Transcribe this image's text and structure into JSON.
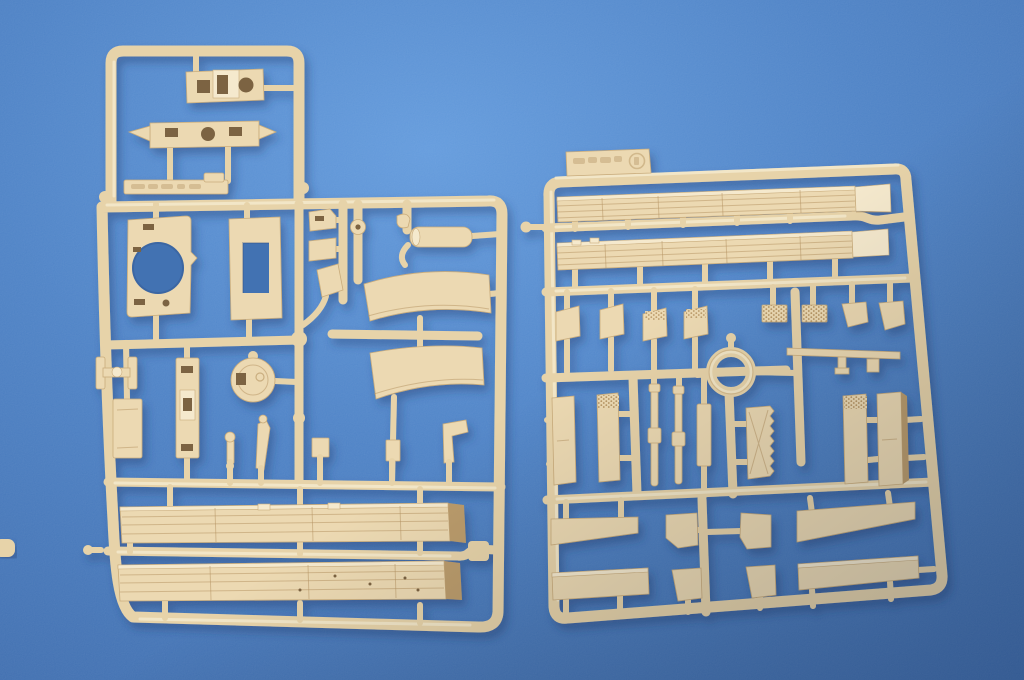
{
  "scene": {
    "type": "photograph",
    "subject": "Two tan injection-molded plastic model kit sprues (part runners) photographed on a blue textured paper backdrop",
    "left_sprue": {
      "shape": "L-shaped frame with narrow upper extension and large lower body",
      "parts": [
        "cab plate with square hatch, raised hatch frame and round opening",
        "front panel bar with pointed ends and three openings",
        "embossed label strip",
        "turret ring plate with large circular opening",
        "frame plate with rectangular opening",
        "two small step brackets",
        "angled wedge piece",
        "eyelet ring",
        "hook fitting",
        "cylindrical muffler with curved pipe",
        "two curved fender panels",
        "axle beam with end flanges",
        "small rectangular panel",
        "tall slotted pillar",
        "round hub disc with slot",
        "five small fittings and levers",
        "two long slatted cargo-bed planks"
      ]
    },
    "right_sprue": {
      "shape": "large rectangular frame with embossed tab at top",
      "parts": [
        "two long slatted side panels with folded ends",
        "two plain mud flaps with posts",
        "two tread-textured mud flaps with posts",
        "two tread-textured grille plates",
        "four small angled flap plates",
        "towing ring",
        "cross-axle bar with center post",
        "flat pillar with slit",
        "two tread-topped pillars",
        "two thin rods with collars",
        "narrow pillar",
        "serrated-edge plate",
        "rectangular box pillar",
        "two tapered side skirts",
        "four angled corner plates",
        "two long sill bars"
      ],
      "tab_marking": "embossed circled stamp and faint raised characters"
    }
  },
  "colors": {
    "bg-base": "#4a80c5",
    "bg-light": "#6099dc",
    "bg-dark": "#3a69ab",
    "bg-hole": "#4372b2",
    "plastic": "#ecd9b2",
    "plastic-light": "#f5e9cd",
    "plastic-edge": "#c9ac7c",
    "plastic-shadow": "#bb9c6c",
    "runner": "#e7d3a9",
    "runner-hi": "#f6ecd2",
    "hole-dark": "#7c6442",
    "groove": "#b4925f",
    "shadow": "#23406f"
  }
}
